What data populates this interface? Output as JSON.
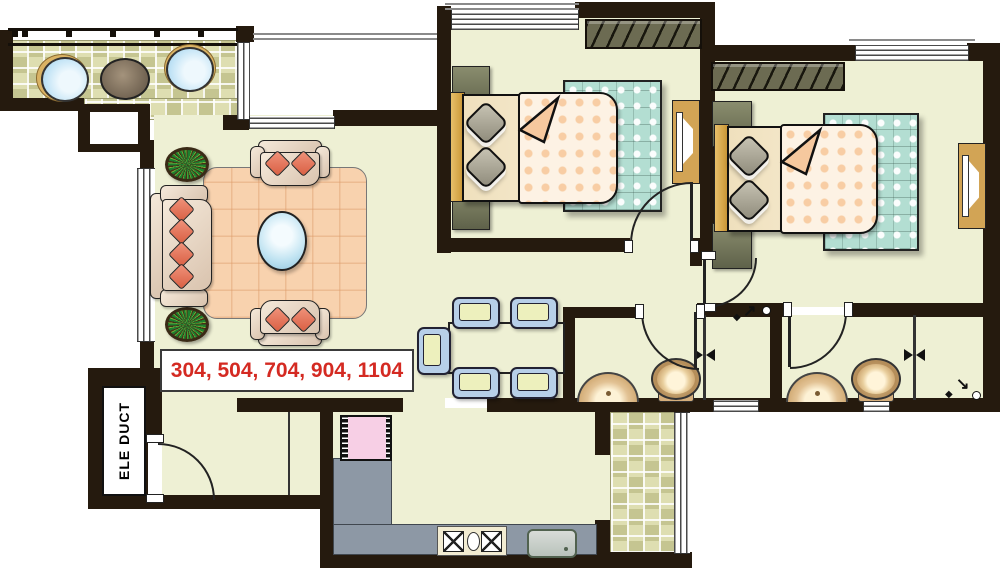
{
  "plan": {
    "unit_numbers": "304, 504, 704, 904, 1104",
    "ele_duct": "ELE DUCT"
  },
  "icons": {
    "shower_head": "◆",
    "shower_arrow_ne": "↗",
    "shower_arrow_se": "↘"
  },
  "colors": {
    "wall": "#251a0e",
    "floor": "#eef0d4",
    "balcony_tile": "#d8d8a4",
    "carpet_peach": "#f8d2ae",
    "bedding_teal": "#b3ded2",
    "blanket_cream": "#fdf2e4",
    "cushion_red": "#e0674c",
    "dining_chair_blue": "#b7cfe8",
    "dining_cushion_yellow": "#edf0bd",
    "counter_gray": "#8d98a5",
    "appliance_pink": "#f7cfe5",
    "wood_tan": "#d2a455",
    "unit_label_red": "#d42a22"
  }
}
